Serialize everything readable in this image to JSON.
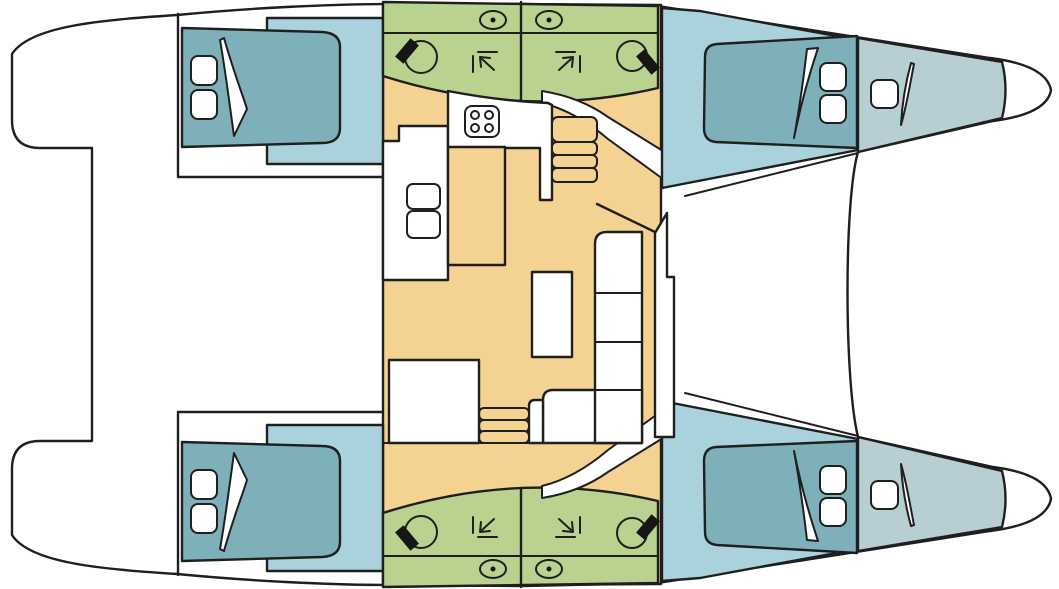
{
  "diagram": {
    "title": "Catamaran interior floor plan",
    "type": "floor-plan",
    "view": "top-down",
    "bow_direction": "right",
    "symmetry": "hulls mirrored top/bottom, central salon asymmetric"
  },
  "colors": {
    "outline": "#1f1f1f",
    "deck_white": "#ffffff",
    "cabin_floor_blue": "#a9d2dc",
    "bed_teal": "#7eb0ba",
    "forepeak_gray": "#b7ced2",
    "bathroom_green": "#b9d28f",
    "salon_floor_tan": "#f3d292",
    "furniture_white": "#ffffff",
    "fixture_black": "#161616"
  },
  "rooms": {
    "salon": "salon and galley on bridgedeck",
    "port_aft_cabin": "double berth cabin",
    "port_aft_head": "bathroom with toilet, sink, shower",
    "port_fwd_head": "bathroom with toilet, sink, shower",
    "port_fwd_cabin": "double berth cabin",
    "port_forepeak": "forepeak berth",
    "stbd_aft_cabin": "double berth cabin",
    "stbd_aft_head": "bathroom with toilet, sink, shower",
    "stbd_fwd_head": "bathroom with toilet, sink, shower",
    "stbd_fwd_cabin": "double berth cabin",
    "stbd_forepeak": "forepeak berth"
  },
  "fixtures": {
    "beds": 4,
    "forepeak_berths": 2,
    "toilets": 4,
    "sinks": 4,
    "showers": 4,
    "stove_burners": 4,
    "galley_basins": 2,
    "stair_flights": 2,
    "sofa": "L-shaped settee",
    "table": "salon table",
    "island": "galley island"
  }
}
